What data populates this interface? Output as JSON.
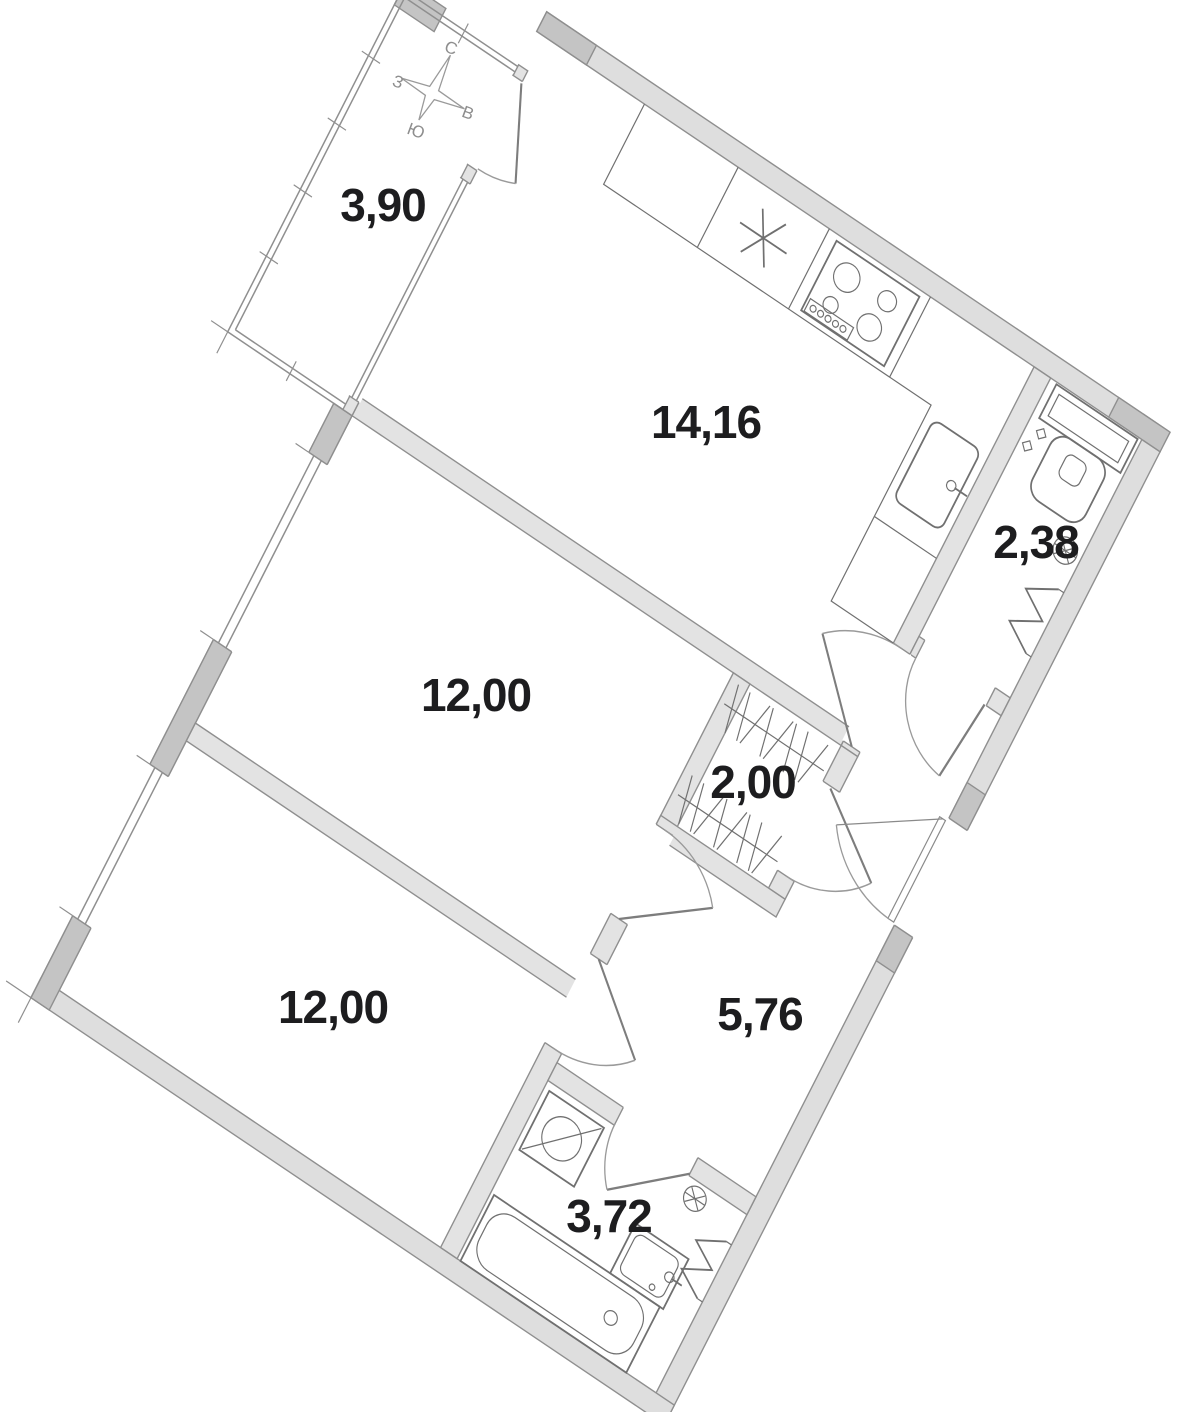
{
  "title": "Apartment floor plan",
  "compass": {
    "north": "С",
    "west": "З",
    "east": "В",
    "south": "Ю"
  },
  "rooms": [
    {
      "id": "balcony",
      "name": "balcony",
      "area": "3,90"
    },
    {
      "id": "kitchen",
      "name": "kitchen-living",
      "area": "14,16"
    },
    {
      "id": "wc",
      "name": "toilet",
      "area": "2,38"
    },
    {
      "id": "room-middle",
      "name": "bedroom",
      "area": "12,00"
    },
    {
      "id": "wardrobe",
      "name": "wardrobe",
      "area": "2,00"
    },
    {
      "id": "room-bottom",
      "name": "bedroom",
      "area": "12,00"
    },
    {
      "id": "hallway",
      "name": "hallway",
      "area": "5,76"
    },
    {
      "id": "bathroom",
      "name": "bathroom",
      "area": "3,72"
    }
  ],
  "fixtures": [
    "fridge",
    "hob",
    "kitchen-sink",
    "toilet",
    "ventilation-grille",
    "heated-towel-rail",
    "wardrobe-rail",
    "washing-machine",
    "bathtub",
    "washbasin"
  ],
  "colors": {
    "wall_fill": "#dedede",
    "wall_dark": "#c4c4c4",
    "interior_wall_fill": "#e3e3e3",
    "line": "#8f8f8f",
    "fixture_line": "#707070",
    "label_text": "#1d1d1f",
    "compass_text": "#8e8e8e",
    "background": "#ffffff"
  }
}
